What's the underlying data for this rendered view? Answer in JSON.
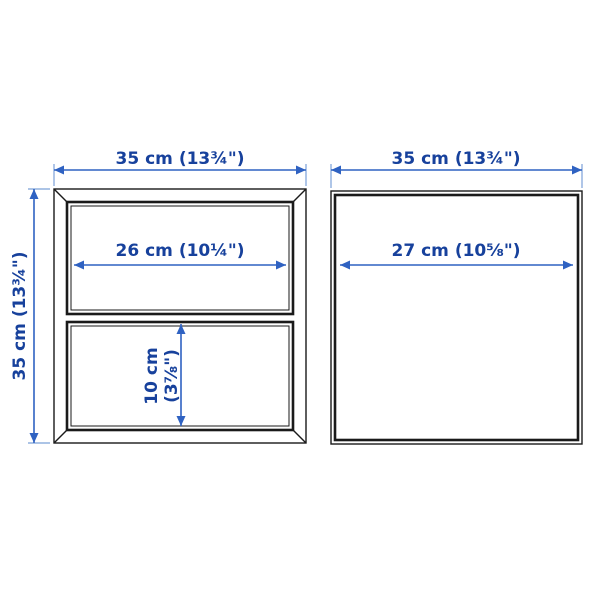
{
  "diagram": {
    "type": "product-dimension-drawing",
    "background": "#ffffff",
    "colors": {
      "outline": "#1a1a1a",
      "dimension_text": "#17419c",
      "dimension_line": "#2f62c2",
      "witness_line": "#7aa0d8"
    },
    "left_unit": {
      "description": "cabinet with two open compartments",
      "overall_width_label": "35 cm (13¾\")",
      "overall_height_label": "35 cm (13¾\")",
      "top_compartment_width_label": "26 cm (10¼\")",
      "bottom_compartment_height_label_line1": "10 cm",
      "bottom_compartment_height_label_line2": "(3⅞\")"
    },
    "right_unit": {
      "description": "open cube cabinet",
      "overall_width_label": "35 cm (13¾\")",
      "interior_width_label": "27 cm (10⅝\")"
    }
  }
}
